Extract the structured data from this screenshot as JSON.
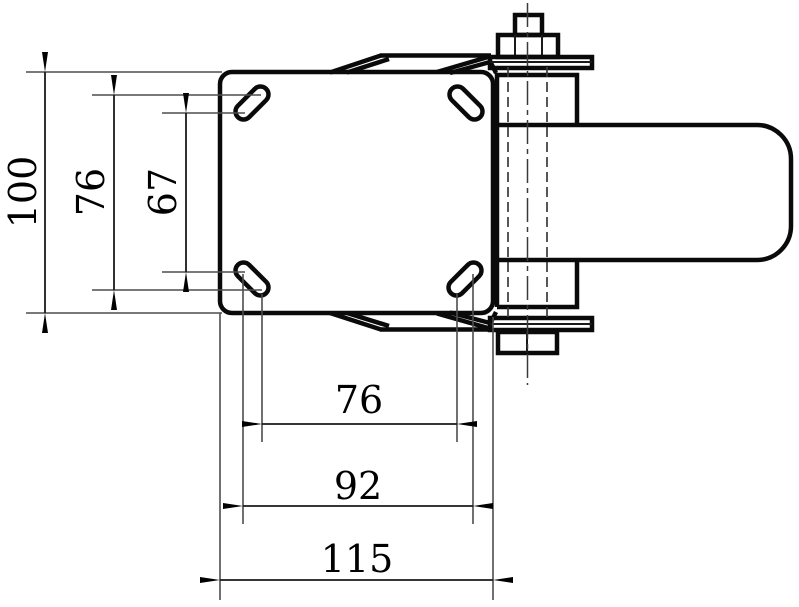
{
  "drawing": {
    "kind": "engineering-dimension-drawing",
    "colors": {
      "background": "#ffffff",
      "outline": "#0a0a0a",
      "construction_lines": "#4d4d4d"
    },
    "dims": {
      "plate_height": "100",
      "bolt_v_outer": "76",
      "bolt_v_inner": "67",
      "bolt_h_inner": "76",
      "bolt_h_outer": "92",
      "plate_width": "115"
    }
  }
}
